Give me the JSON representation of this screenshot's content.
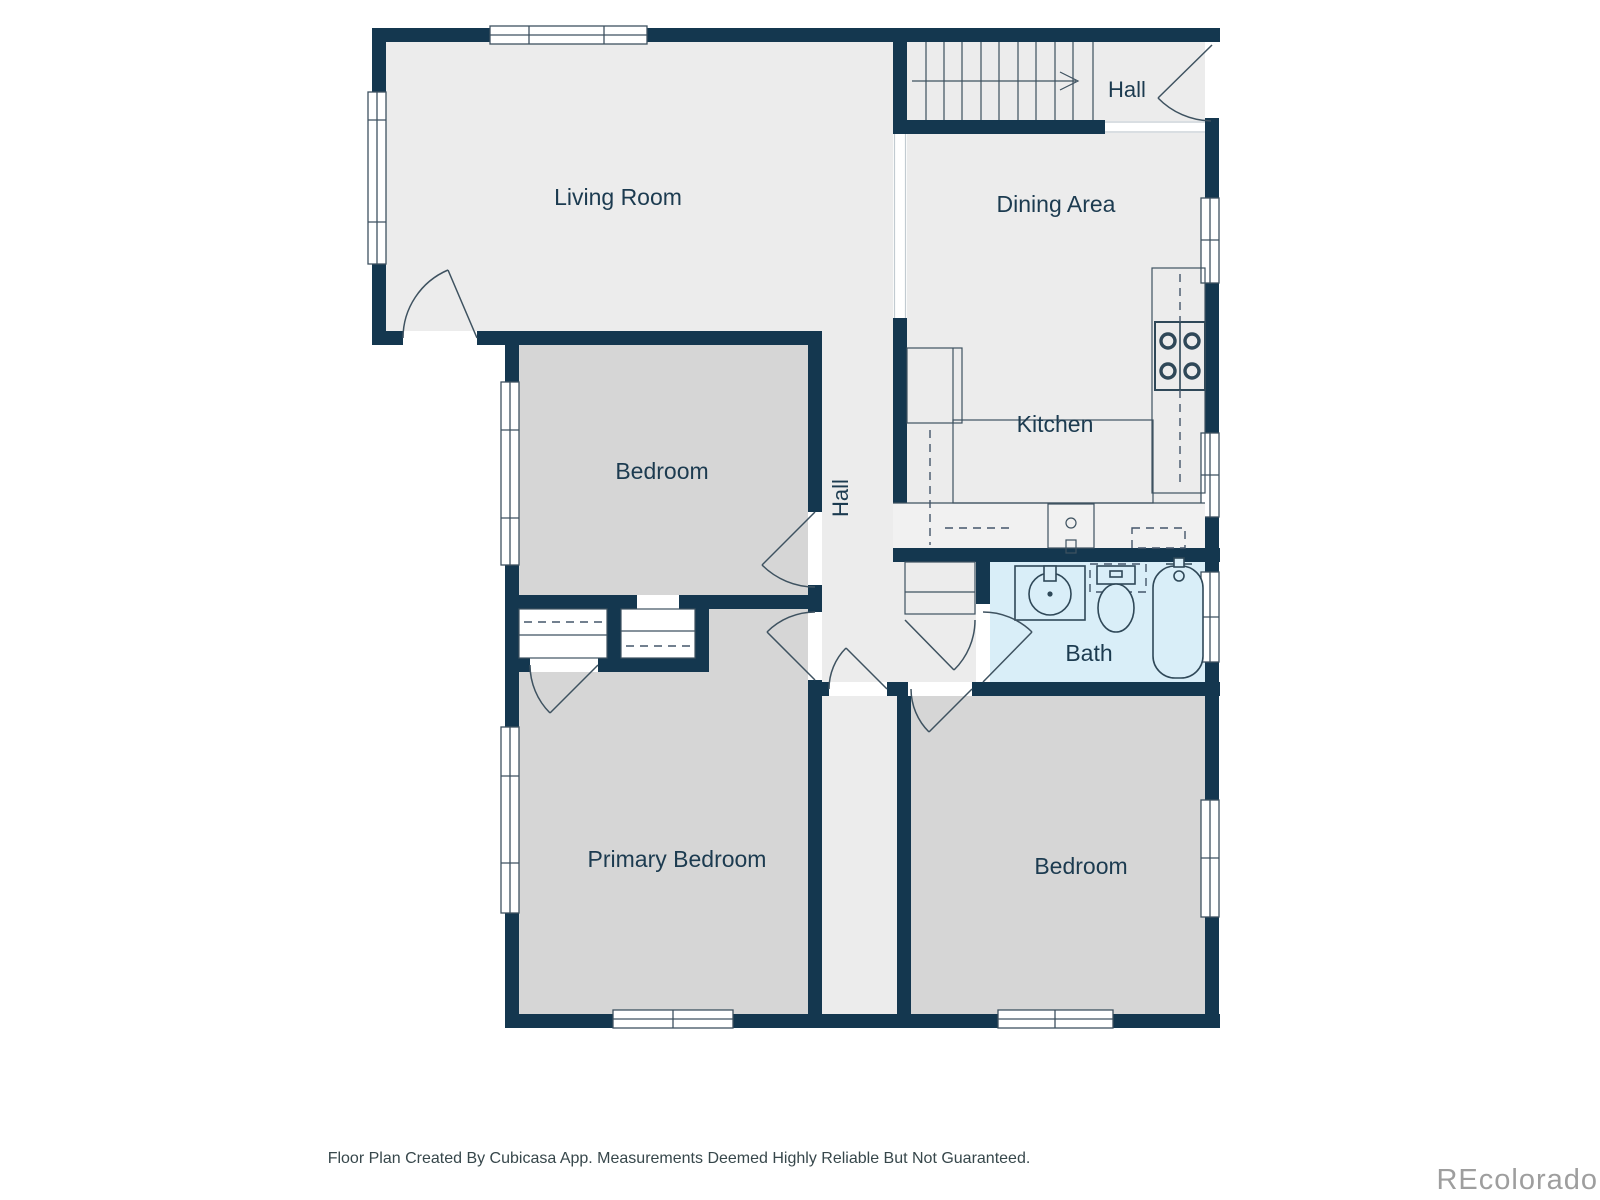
{
  "colors": {
    "wall": "#14374F",
    "floor_light": "#ECECEC",
    "floor_bedroom": "#D6D6D6",
    "floor_bath": "#D9EEF8",
    "floor_closet": "#FAFAFA",
    "counter_fill": "#F1F1F1",
    "window_fill": "#FFFFFF",
    "outline": "#3E5260",
    "label_text": "#1C3B50",
    "footer_text": "#37474B",
    "watermark_text": "#9E9E9E"
  },
  "rooms": {
    "living_room": "Living Room",
    "hall_upper": "Hall",
    "dining_area": "Dining Area",
    "kitchen": "Kitchen",
    "hall_center": "Hall",
    "bedroom_mid": "Bedroom",
    "bath": "Bath",
    "primary_bedroom": "Primary Bedroom",
    "bedroom_lower": "Bedroom"
  },
  "footer": {
    "disclaimer": "Floor Plan Created By Cubicasa App. Measurements Deemed Highly Reliable But Not Guaranteed.",
    "watermark": "REcolorado"
  }
}
